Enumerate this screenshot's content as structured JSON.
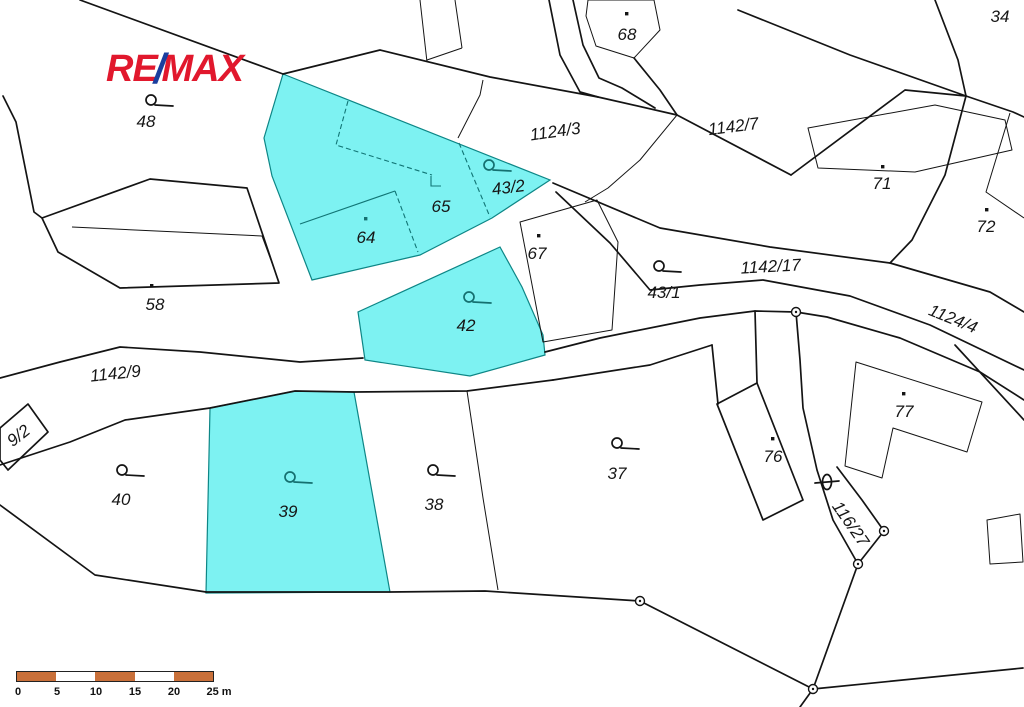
{
  "logo": {
    "re": "RE",
    "slash": "/",
    "max": "MAX"
  },
  "map": {
    "labels": {
      "p48": "48",
      "p34": "34",
      "p68": "68",
      "p71": "71",
      "p72": "72",
      "p58": "58",
      "p64": "64",
      "p65": "65",
      "p67": "67",
      "p43_2": "43/2",
      "p43_1": "43/1",
      "p42": "42",
      "p40": "40",
      "p39": "39",
      "p38": "38",
      "p37": "37",
      "p76": "76",
      "p77": "77",
      "p9_2": "9/2",
      "p116_27": "116/27",
      "r1124_3": "1124/3",
      "r1142_7": "1142/7",
      "r1142_17": "1142/17",
      "r1124_4": "1124/4",
      "r1142_9": "1142/9"
    },
    "highlighted_parcels": [
      "65",
      "64",
      "43/2",
      "42",
      "39"
    ]
  },
  "scale_bar": {
    "ticks": [
      "0",
      "5",
      "10",
      "15",
      "20",
      "25 m"
    ]
  },
  "colors": {
    "parcel_highlight": "#7df2f2",
    "label_teal": "#157070",
    "scale_orange": "#c9703a",
    "logo_red": "#e1182d",
    "logo_blue": "#1a3e9e",
    "line_black": "#141414"
  }
}
